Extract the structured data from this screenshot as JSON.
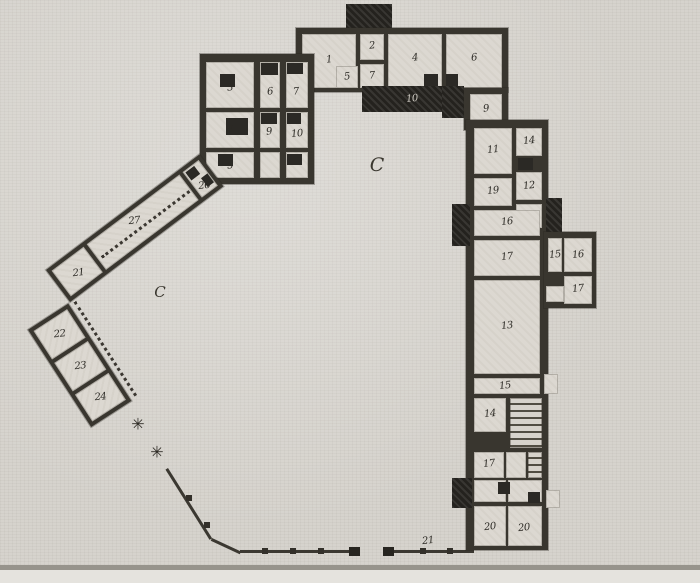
{
  "palette": {
    "paper": "#d6d3cd",
    "room_fill": "#dcd8d1",
    "wall": "#39362f",
    "dark_block": "#24221e",
    "label_ink": "#2c2a25"
  },
  "plan": {
    "courtyards": [
      {
        "label": "C"
      },
      {
        "label": "C"
      }
    ],
    "icons": {
      "gate_post_icon": "✳"
    },
    "rooms": {
      "r1": {
        "label": "1"
      },
      "r2": {
        "label": "2"
      },
      "r7a": {
        "label": "7"
      },
      "r5": {
        "label": "5"
      },
      "r4": {
        "label": "4"
      },
      "r6": {
        "label": "6"
      },
      "terrace": {
        "label": "10"
      },
      "r9top": {
        "label": "9"
      },
      "r3": {
        "label": "3"
      },
      "r6b": {
        "label": "6"
      },
      "r7b": {
        "label": "7"
      },
      "r8": {
        "label": "8"
      },
      "r9b": {
        "label": "9"
      },
      "r10b": {
        "label": "10"
      },
      "r5b": {
        "label": "5"
      },
      "c21": {
        "label": "21"
      },
      "g27": {
        "label": "27"
      },
      "e26": {
        "label": "26"
      },
      "r22": {
        "label": "22"
      },
      "r23": {
        "label": "23"
      },
      "r24": {
        "label": "24"
      },
      "r11": {
        "label": "11"
      },
      "r14": {
        "label": "14"
      },
      "r12": {
        "label": "12"
      },
      "r19": {
        "label": "19"
      },
      "r16": {
        "label": "16"
      },
      "r17": {
        "label": "17"
      },
      "r15a": {
        "label": "15"
      },
      "r16a": {
        "label": "16"
      },
      "r17a": {
        "label": "17"
      },
      "r13": {
        "label": "13"
      },
      "r15c": {
        "label": "15"
      },
      "r14b": {
        "label": "14"
      },
      "r17b": {
        "label": "17"
      },
      "r20a": {
        "label": "20"
      },
      "r20b": {
        "label": "20"
      },
      "fence": {
        "label": "21"
      }
    }
  }
}
